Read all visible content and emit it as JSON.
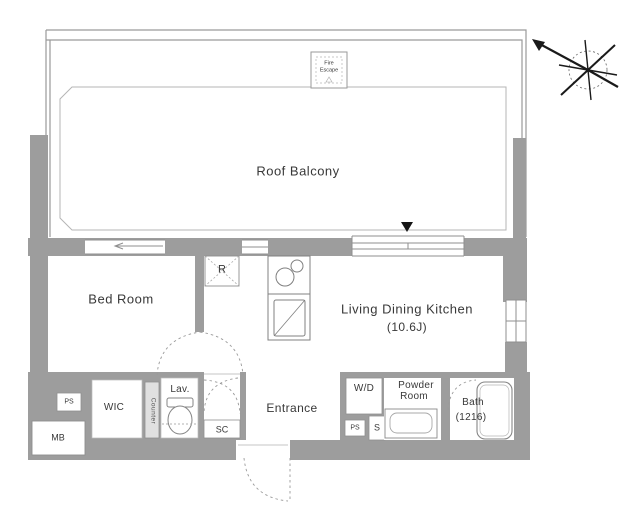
{
  "rooms": {
    "roof_balcony": "Roof Balcony",
    "bed_room": "Bed Room",
    "ldk_line1": "Living Dining Kitchen",
    "ldk_line2": "(10.6J)",
    "wic": "WIC",
    "lav": "Lav.",
    "entrance": "Entrance",
    "powder_line1": "Powder",
    "powder_line2": "Room",
    "bath_line1": "Bath",
    "bath_line2": "(1216)"
  },
  "fixtures": {
    "refrigerator": "R",
    "washer_dryer": "W/D",
    "shoe_cupboard": "SC",
    "pipe_shaft_left": "PS",
    "pipe_shaft_right": "PS",
    "meter_box": "MB",
    "counter": "Counter",
    "valve_symbol": "S",
    "fire_escape_line1": "Fire",
    "fire_escape_line2": "Escape"
  },
  "icons": {
    "compass": "compass-north-arrow-icon",
    "window_marker": "triangle-down-marker-icon"
  },
  "colors": {
    "wall": "#9d9d9d",
    "line": "#8f8f8f",
    "dash": "#9a9a9a",
    "text": "#383838"
  }
}
